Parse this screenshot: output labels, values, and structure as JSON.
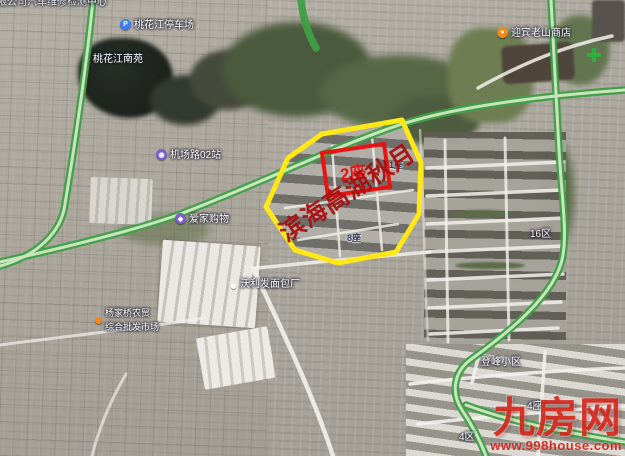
{
  "overlay": {
    "project_name": "滨海高湖秋月",
    "highlight_block": "2座",
    "block_labels": {
      "b1": "1座",
      "b8": "8座",
      "b4": "4座"
    },
    "district_labels": {
      "d16": "16区",
      "d4": "4区",
      "xiaoqu": "登峰小区"
    },
    "colors": {
      "boundary": "#ffe816",
      "highlight_box": "#e81313",
      "project_text": "#a81111",
      "road_green": "#3f9f47"
    }
  },
  "poi": {
    "car_center": "限公司汽车维修检测中心",
    "parking": "桃花江停车场",
    "garden": "桃花江南苑",
    "station": "机场路02站",
    "shopping": "爱家购物",
    "market_line1": "杨家桥农贸",
    "market_line2": "综合批发市场",
    "bakery": "沃利发面包厂",
    "shop_tr": "迎宾老山商店"
  },
  "icons": {
    "parking": "parking-icon",
    "station": "metro-station-icon",
    "shopping": "shopping-bag-icon",
    "market": "poi-dot-icon",
    "shop_tr": "poi-dot-icon",
    "cross": "green-cross-icon"
  },
  "watermark": {
    "logo": "九房网",
    "url": "www.998house.com",
    "color": "#d5281c"
  }
}
